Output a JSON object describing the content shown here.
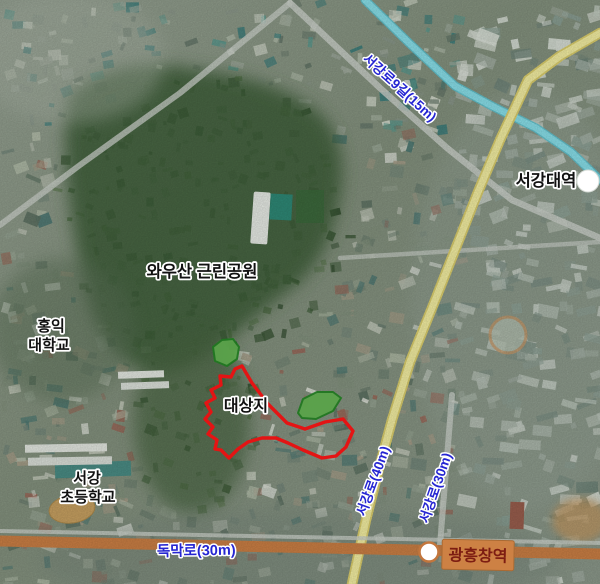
{
  "map": {
    "type": "satellite-aerial-map",
    "labels": {
      "park": "와우산 근린공원",
      "university_line1": "홍익",
      "university_line2": "대학교",
      "site": "대상지",
      "elementary_line1": "서강",
      "elementary_line2": "초등학교",
      "station_right": "서강대역",
      "station_bottom": "광흥창역",
      "road_top_diagonal": "서강로9길(15m)",
      "road_vertical_40m": "서강로(40m)",
      "road_vertical_30m": "서강로(30m)",
      "road_bottom_horizontal": "독막로(30m)"
    },
    "colors": {
      "boundary_red": "#e41414",
      "road_yellow": "#f6f1a3",
      "road_yellow_edge": "#ddd06e",
      "road_cyan": "#8ae2ec",
      "road_orange": "#cd8045",
      "road_gray": "#ccd2cb",
      "label_blue": "#2525d2",
      "label_black": "#111111",
      "halo_white": "#ffffff",
      "station_box_orange": "#cd8144",
      "station_box_edge": "#a96a33",
      "station_text_maroon": "#7d1d12",
      "park_green_fill": "#5aa34a",
      "park_green_edge": "#217821",
      "forest_green": "#41603a"
    }
  }
}
